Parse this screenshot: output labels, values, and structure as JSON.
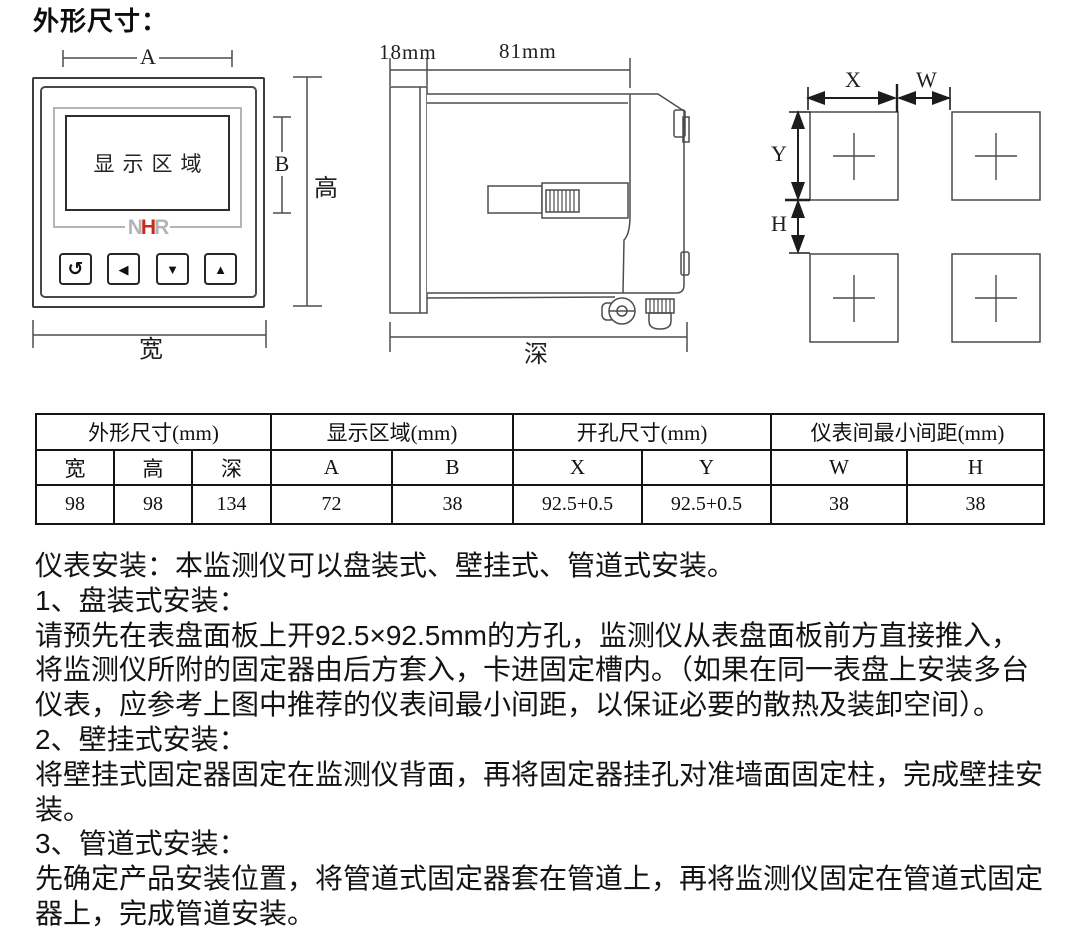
{
  "title": "外形尺寸：",
  "front_view": {
    "display_label": "显示区域",
    "logo": {
      "n": "N",
      "h": "H",
      "r": "R",
      "gray_color": "#b2b5b7",
      "red_color": "#c8281e"
    },
    "buttons": [
      {
        "icon": "↺"
      },
      {
        "icon": "◀"
      },
      {
        "icon": "▼"
      },
      {
        "icon": "▲"
      }
    ],
    "dims": {
      "a": "A",
      "b": "B",
      "height": "高",
      "width": "宽"
    }
  },
  "side_view": {
    "dims": {
      "front_depth": "18mm",
      "body_depth": "81mm",
      "depth": "深"
    }
  },
  "cutout_view": {
    "dims": {
      "x": "X",
      "w": "W",
      "y": "Y",
      "h": "H"
    }
  },
  "table": {
    "groups": [
      {
        "label": "外形尺寸(mm)"
      },
      {
        "label": "显示区域(mm)"
      },
      {
        "label": "开孔尺寸(mm)"
      },
      {
        "label": "仪表间最小间距(mm)"
      }
    ],
    "headers": [
      "宽",
      "高",
      "深",
      "A",
      "B",
      "X",
      "Y",
      "W",
      "H"
    ],
    "values": [
      "98",
      "98",
      "134",
      "72",
      "38",
      "92.5+0.5",
      "92.5+0.5",
      "38",
      "38"
    ]
  },
  "install": {
    "lines": [
      "仪表安装：本监测仪可以盘装式、壁挂式、管道式安装。",
      "1、盘装式安装：",
      "请预先在表盘面板上开92.5×92.5mm的方孔，监测仪从表盘面板前方直接推入，",
      "将监测仪所附的固定器由后方套入，卡进固定槽内。（如果在同一表盘上安装多台",
      "仪表，应参考上图中推荐的仪表间最小间距，以保证必要的散热及装卸空间）。",
      "2、壁挂式安装：",
      "将壁挂式固定器固定在监测仪背面，再将固定器挂孔对准墙面固定柱，完成壁挂安",
      "装。",
      "3、管道式安装：",
      "先确定产品安装位置，将管道式固定器套在管道上，再将监测仪固定在管道式固定",
      "器上，完成管道安装。"
    ]
  }
}
